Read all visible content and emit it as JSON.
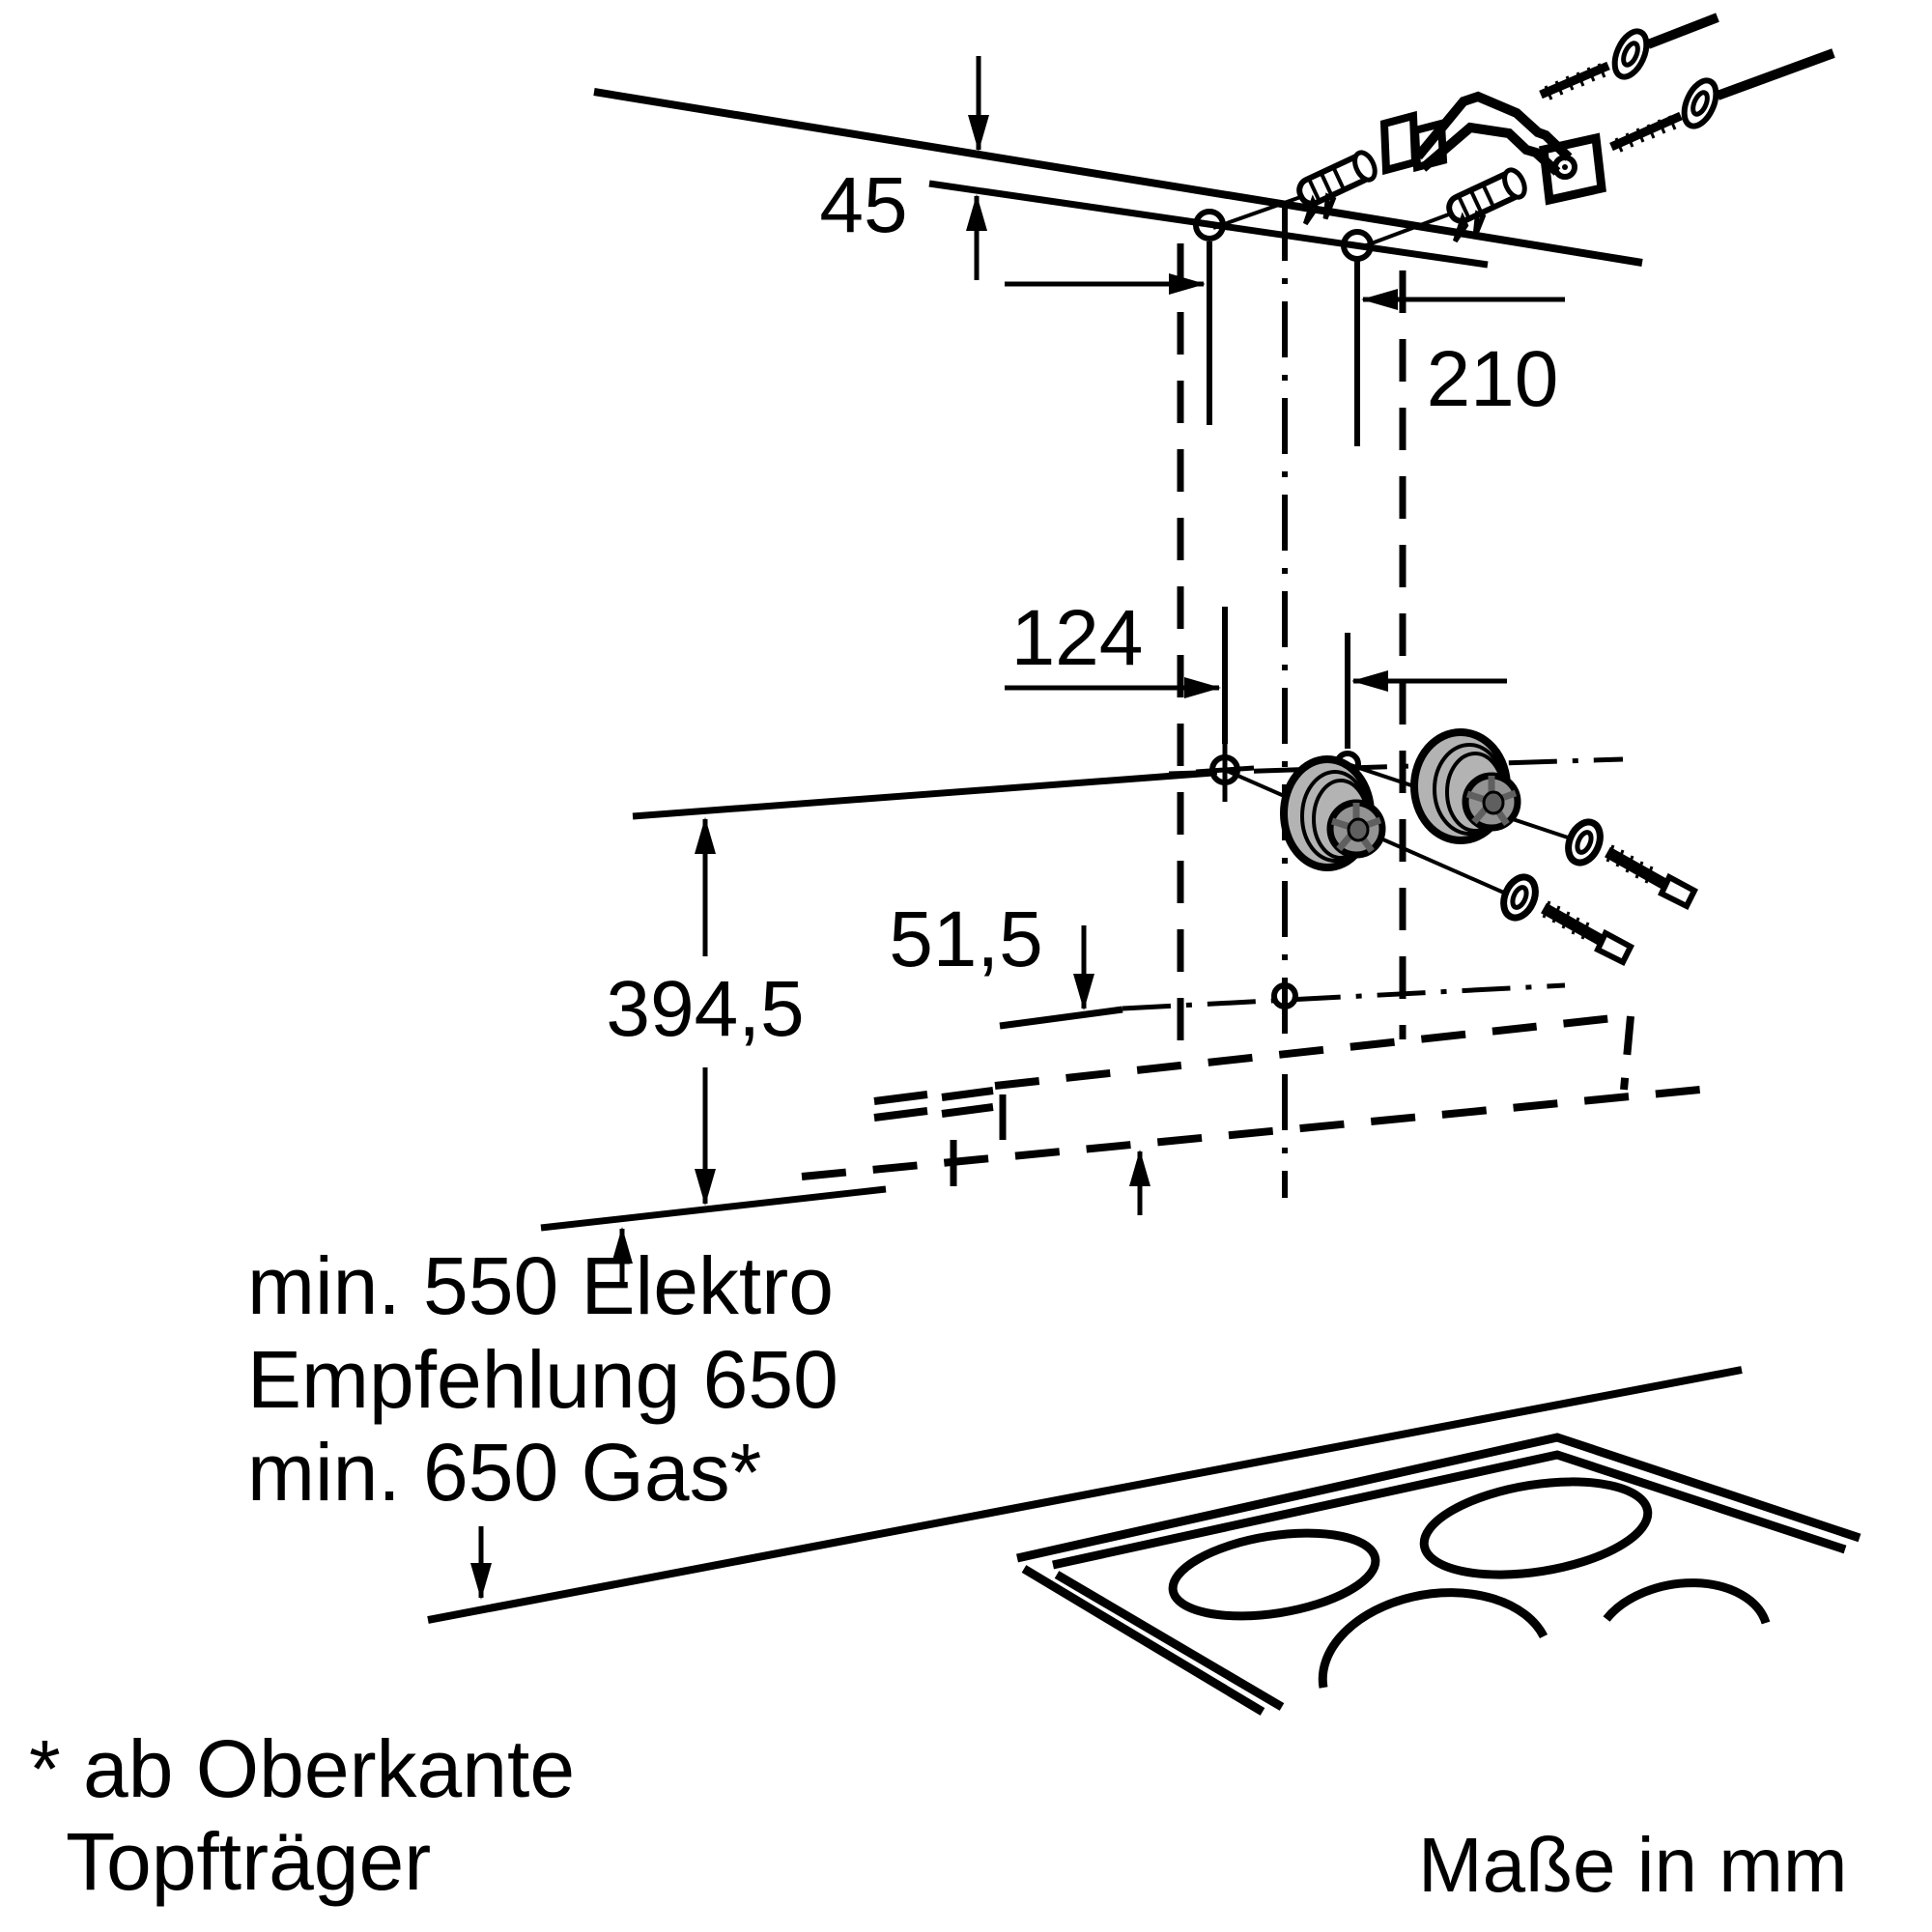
{
  "dims": {
    "d45": "45",
    "d210": "210",
    "d124": "124",
    "d394_5": "394,5",
    "d51_5": "51,5"
  },
  "clearance": {
    "l1": "min. 550 Elektro",
    "l2": "Empfehlung 650",
    "l3": "min. 650 Gas*"
  },
  "footnote": {
    "l1": "* ab Oberkante",
    "l2": "Topfträger"
  },
  "units": {
    "note": "Maße in mm"
  },
  "colors": {
    "line": "#000000",
    "spacer_gray": "#b3b3b3",
    "hub_gray": "#939393",
    "hub_dark": "#5f5f5f",
    "background": "#ffffff"
  }
}
